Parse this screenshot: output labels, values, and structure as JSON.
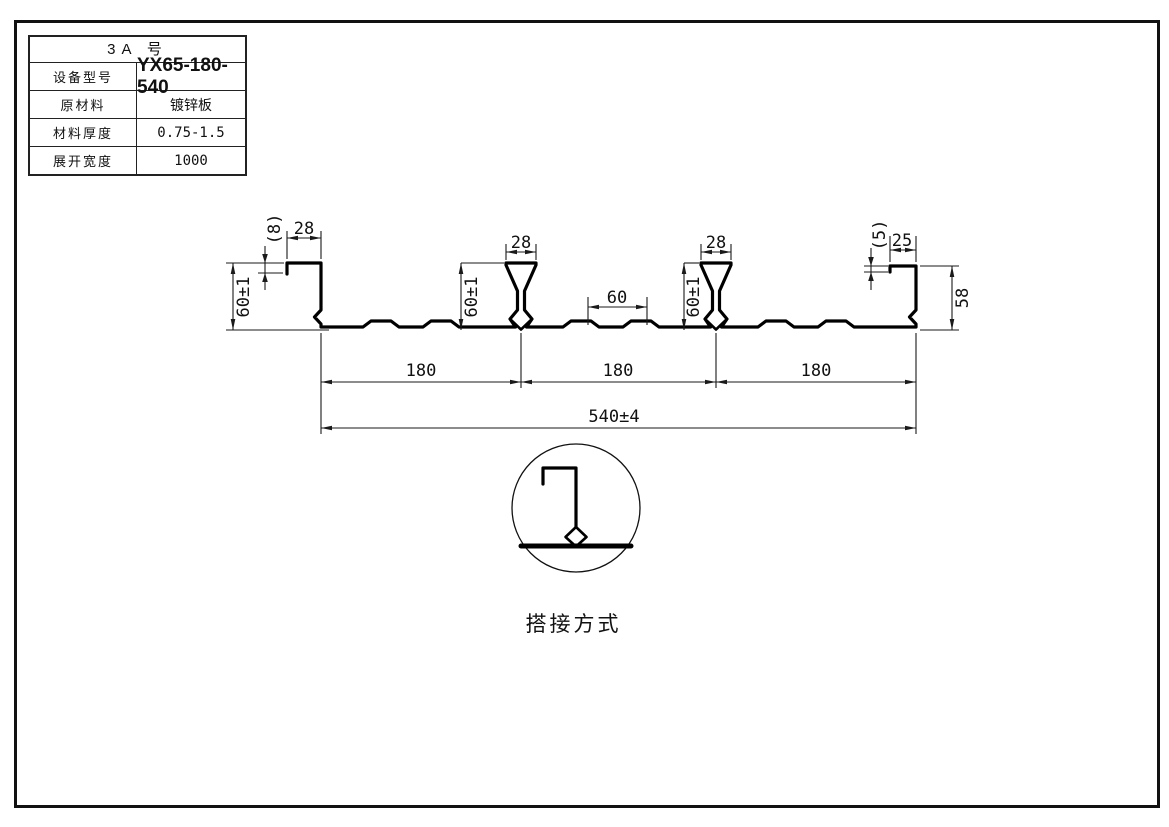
{
  "ink": "#111111",
  "spec_table": {
    "title": "3A 号",
    "rows": [
      {
        "label": "设备型号",
        "value": "YX65-180-540"
      },
      {
        "label": "原材料",
        "value": "镀锌板"
      },
      {
        "label": "材料厚度",
        "value": "0.75-1.5"
      },
      {
        "label": "展开宽度",
        "value": "1000"
      }
    ]
  },
  "dimensions": {
    "left_lip_drop": "(8)",
    "left_lip_width": "28",
    "left_height": "60±1",
    "rib1_top_width": "28",
    "rib1_height": "60±1",
    "rib2_top_width": "28",
    "rib2_height": "60±1",
    "flange_bump_width": "60",
    "right_lip_drop": "(5)",
    "right_lip_width": "25",
    "right_height": "58",
    "pitch1": "180",
    "pitch2": "180",
    "pitch3": "180",
    "overall_width": "540±4"
  },
  "detail": {
    "caption": "搭接方式"
  }
}
